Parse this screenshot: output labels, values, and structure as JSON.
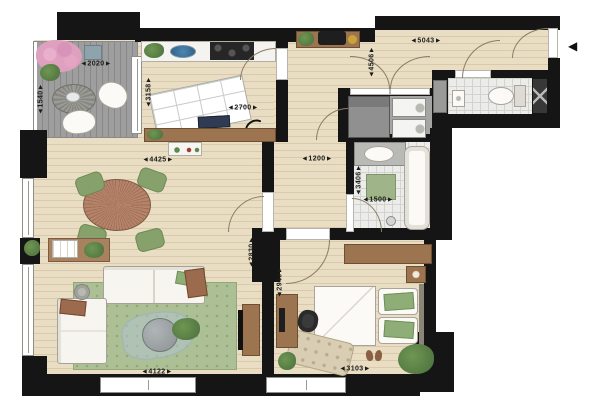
{
  "canvas": {
    "width": 600,
    "height": 400
  },
  "colors": {
    "wall": "#151515",
    "wood_floor": "#e9dec3",
    "balcony_deck": "#9e9e9e",
    "bathroom_tile": "#ececea",
    "utility_floor": "#a5a5a3",
    "rug_green": "#adbf95",
    "furniture_brown": "#9c7450",
    "chair_green": "#87a16c",
    "dim_text": "#1b1b1b"
  },
  "icons": {
    "entry_arrow": "◀"
  },
  "dims": [
    {
      "id": "balcony-width",
      "label": "◄2020►",
      "orient": "h"
    },
    {
      "id": "balcony-depth",
      "label": "◄1540►",
      "orient": "v"
    },
    {
      "id": "kitchen-depth",
      "label": "◄3158►",
      "orient": "v"
    },
    {
      "id": "kitchen-width",
      "label": "◄2700►",
      "orient": "h"
    },
    {
      "id": "dining-width",
      "label": "◄4425►",
      "orient": "h"
    },
    {
      "id": "hall-width",
      "label": "◄5043►",
      "orient": "h"
    },
    {
      "id": "hall-depth",
      "label": "◄4506►",
      "orient": "v"
    },
    {
      "id": "corridor-width",
      "label": "◄1200►",
      "orient": "h"
    },
    {
      "id": "bathroom-depth",
      "label": "◄3406►",
      "orient": "v"
    },
    {
      "id": "bathroom-width",
      "label": "◄1500►",
      "orient": "h"
    },
    {
      "id": "living-depth",
      "label": "◄2830►",
      "orient": "v"
    },
    {
      "id": "bedroom-depth",
      "label": "◄2940►",
      "orient": "v"
    },
    {
      "id": "living-width",
      "label": "◄4122►",
      "orient": "h"
    },
    {
      "id": "bedroom-width",
      "label": "◄3103►",
      "orient": "h"
    }
  ]
}
